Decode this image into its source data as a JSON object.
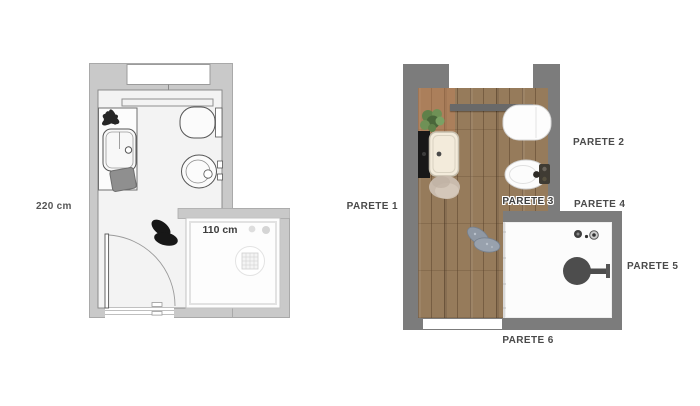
{
  "left_plan": {
    "room_width_label": "220 cm",
    "shower_width_label": "110 cm"
  },
  "right_plan": {
    "wall_labels": {
      "parete_1": "PARETE 1",
      "parete_2": "PARETE 2",
      "parete_3": "PARETE 3",
      "parete_4": "PARETE 4",
      "parete_5": "PARETE 5",
      "parete_6": "PARETE 6"
    }
  },
  "icons": {
    "plant": "plant-icon",
    "slippers": "slippers-icon",
    "shower_head": "shower-head-icon",
    "drain": "drain-icon",
    "faucet": "faucet-icon"
  },
  "colors": {
    "left_plan_wall": "#c9c9c9",
    "left_plan_floor": "#f3f3f3",
    "right_plan_wall": "#7c7c7c",
    "wood_floor": "#967b5b",
    "fixture_dark": "#4d4d4d",
    "vanity_black": "#181818",
    "label_text": "#4a4a4a"
  }
}
